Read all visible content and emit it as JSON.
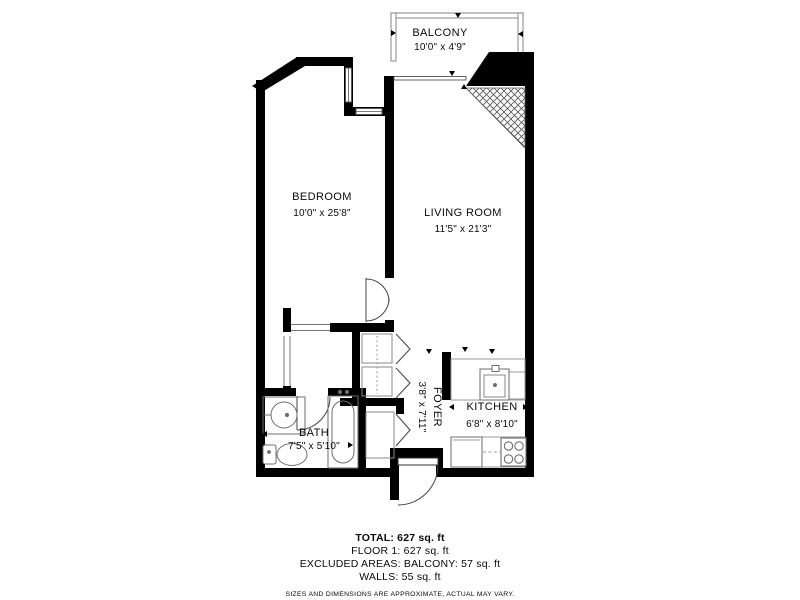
{
  "colors": {
    "wall": "#000000",
    "fixture_line": "#6e6e6e",
    "railing": "#9a9a9a",
    "text": "#0a0a0a"
  },
  "floor_plan": {
    "rooms": [
      {
        "name": "BALCONY",
        "dimensions": "10'0\" x 4'9\""
      },
      {
        "name": "BEDROOM",
        "dimensions": "10'0\" x 25'8\""
      },
      {
        "name": "LIVING ROOM",
        "dimensions": "11'5\" x 21'3\""
      },
      {
        "name": "FOYER",
        "dimensions": "3'8\" x 7'11\""
      },
      {
        "name": "KITCHEN",
        "dimensions": "6'8\" x 8'10\""
      },
      {
        "name": "BATH",
        "dimensions": "7'5\" x 5'10\""
      }
    ]
  },
  "summary": {
    "total": "TOTAL: 627 sq. ft",
    "floor": "FLOOR 1: 627 sq. ft",
    "excluded_areas": "EXCLUDED AREAS: BALCONY: 57 sq. ft",
    "walls": "WALLS: 55 sq. ft",
    "disclaimer": "SIZES AND DIMENSIONS ARE APPROXIMATE, ACTUAL MAY VARY."
  }
}
